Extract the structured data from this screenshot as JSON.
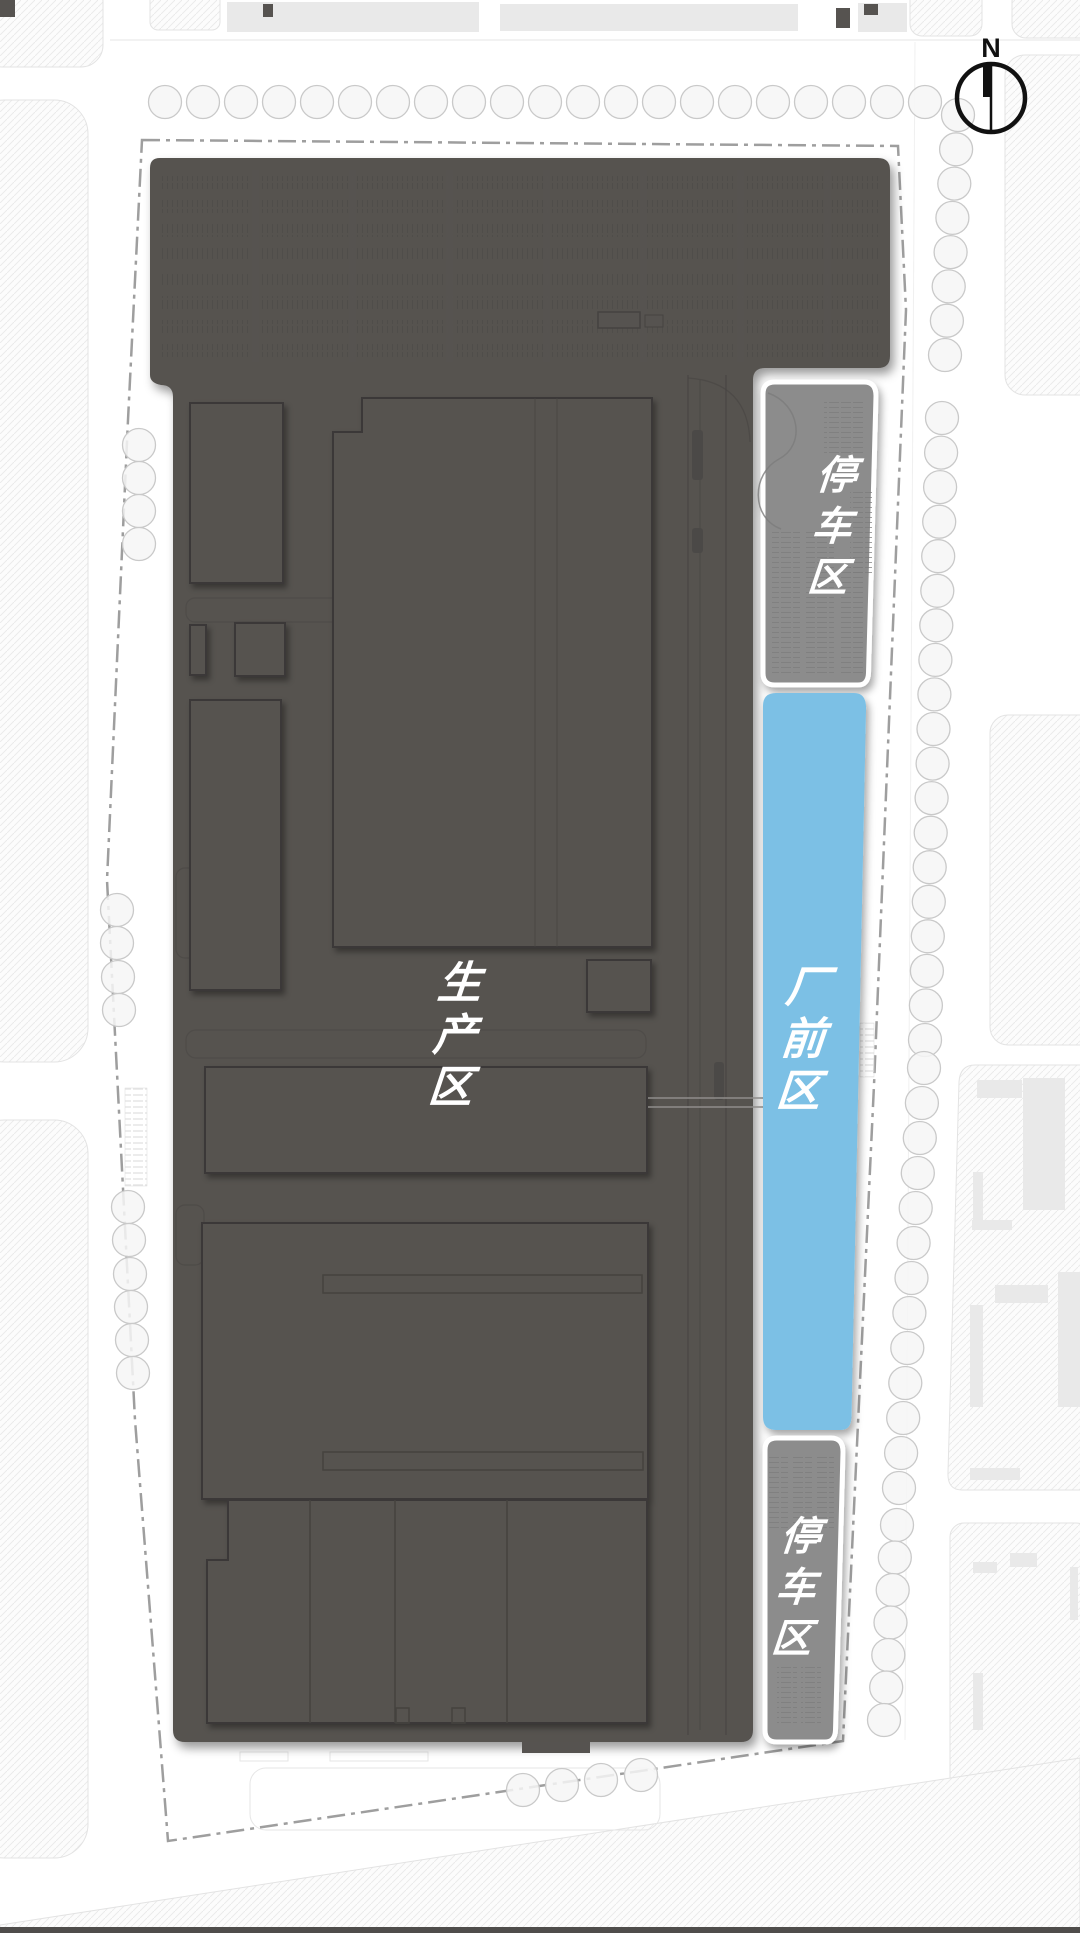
{
  "compass": {
    "north_label": "N"
  },
  "zones": {
    "production": {
      "name": "生产区",
      "chars": [
        "生",
        "产",
        "区"
      ],
      "color": "#565350"
    },
    "factory_front": {
      "name": "厂前区",
      "chars": [
        "厂",
        "前",
        "区"
      ],
      "color": "#7CC0E5"
    },
    "parking_north": {
      "name": "停车区",
      "chars": [
        "停",
        "车",
        "区"
      ],
      "color": "#8C8C8C"
    },
    "parking_south": {
      "name": "停车区",
      "chars": [
        "停",
        "车",
        "区"
      ],
      "color": "#8C8C8C"
    }
  },
  "palette": {
    "front_blue": "#7CC0E5",
    "production_gray": "#565350",
    "parking_gray": "#8C8C8C",
    "boundary_gray": "#9E9E9E",
    "label_white": "#FFFFFF",
    "compass_black": "#111111"
  }
}
